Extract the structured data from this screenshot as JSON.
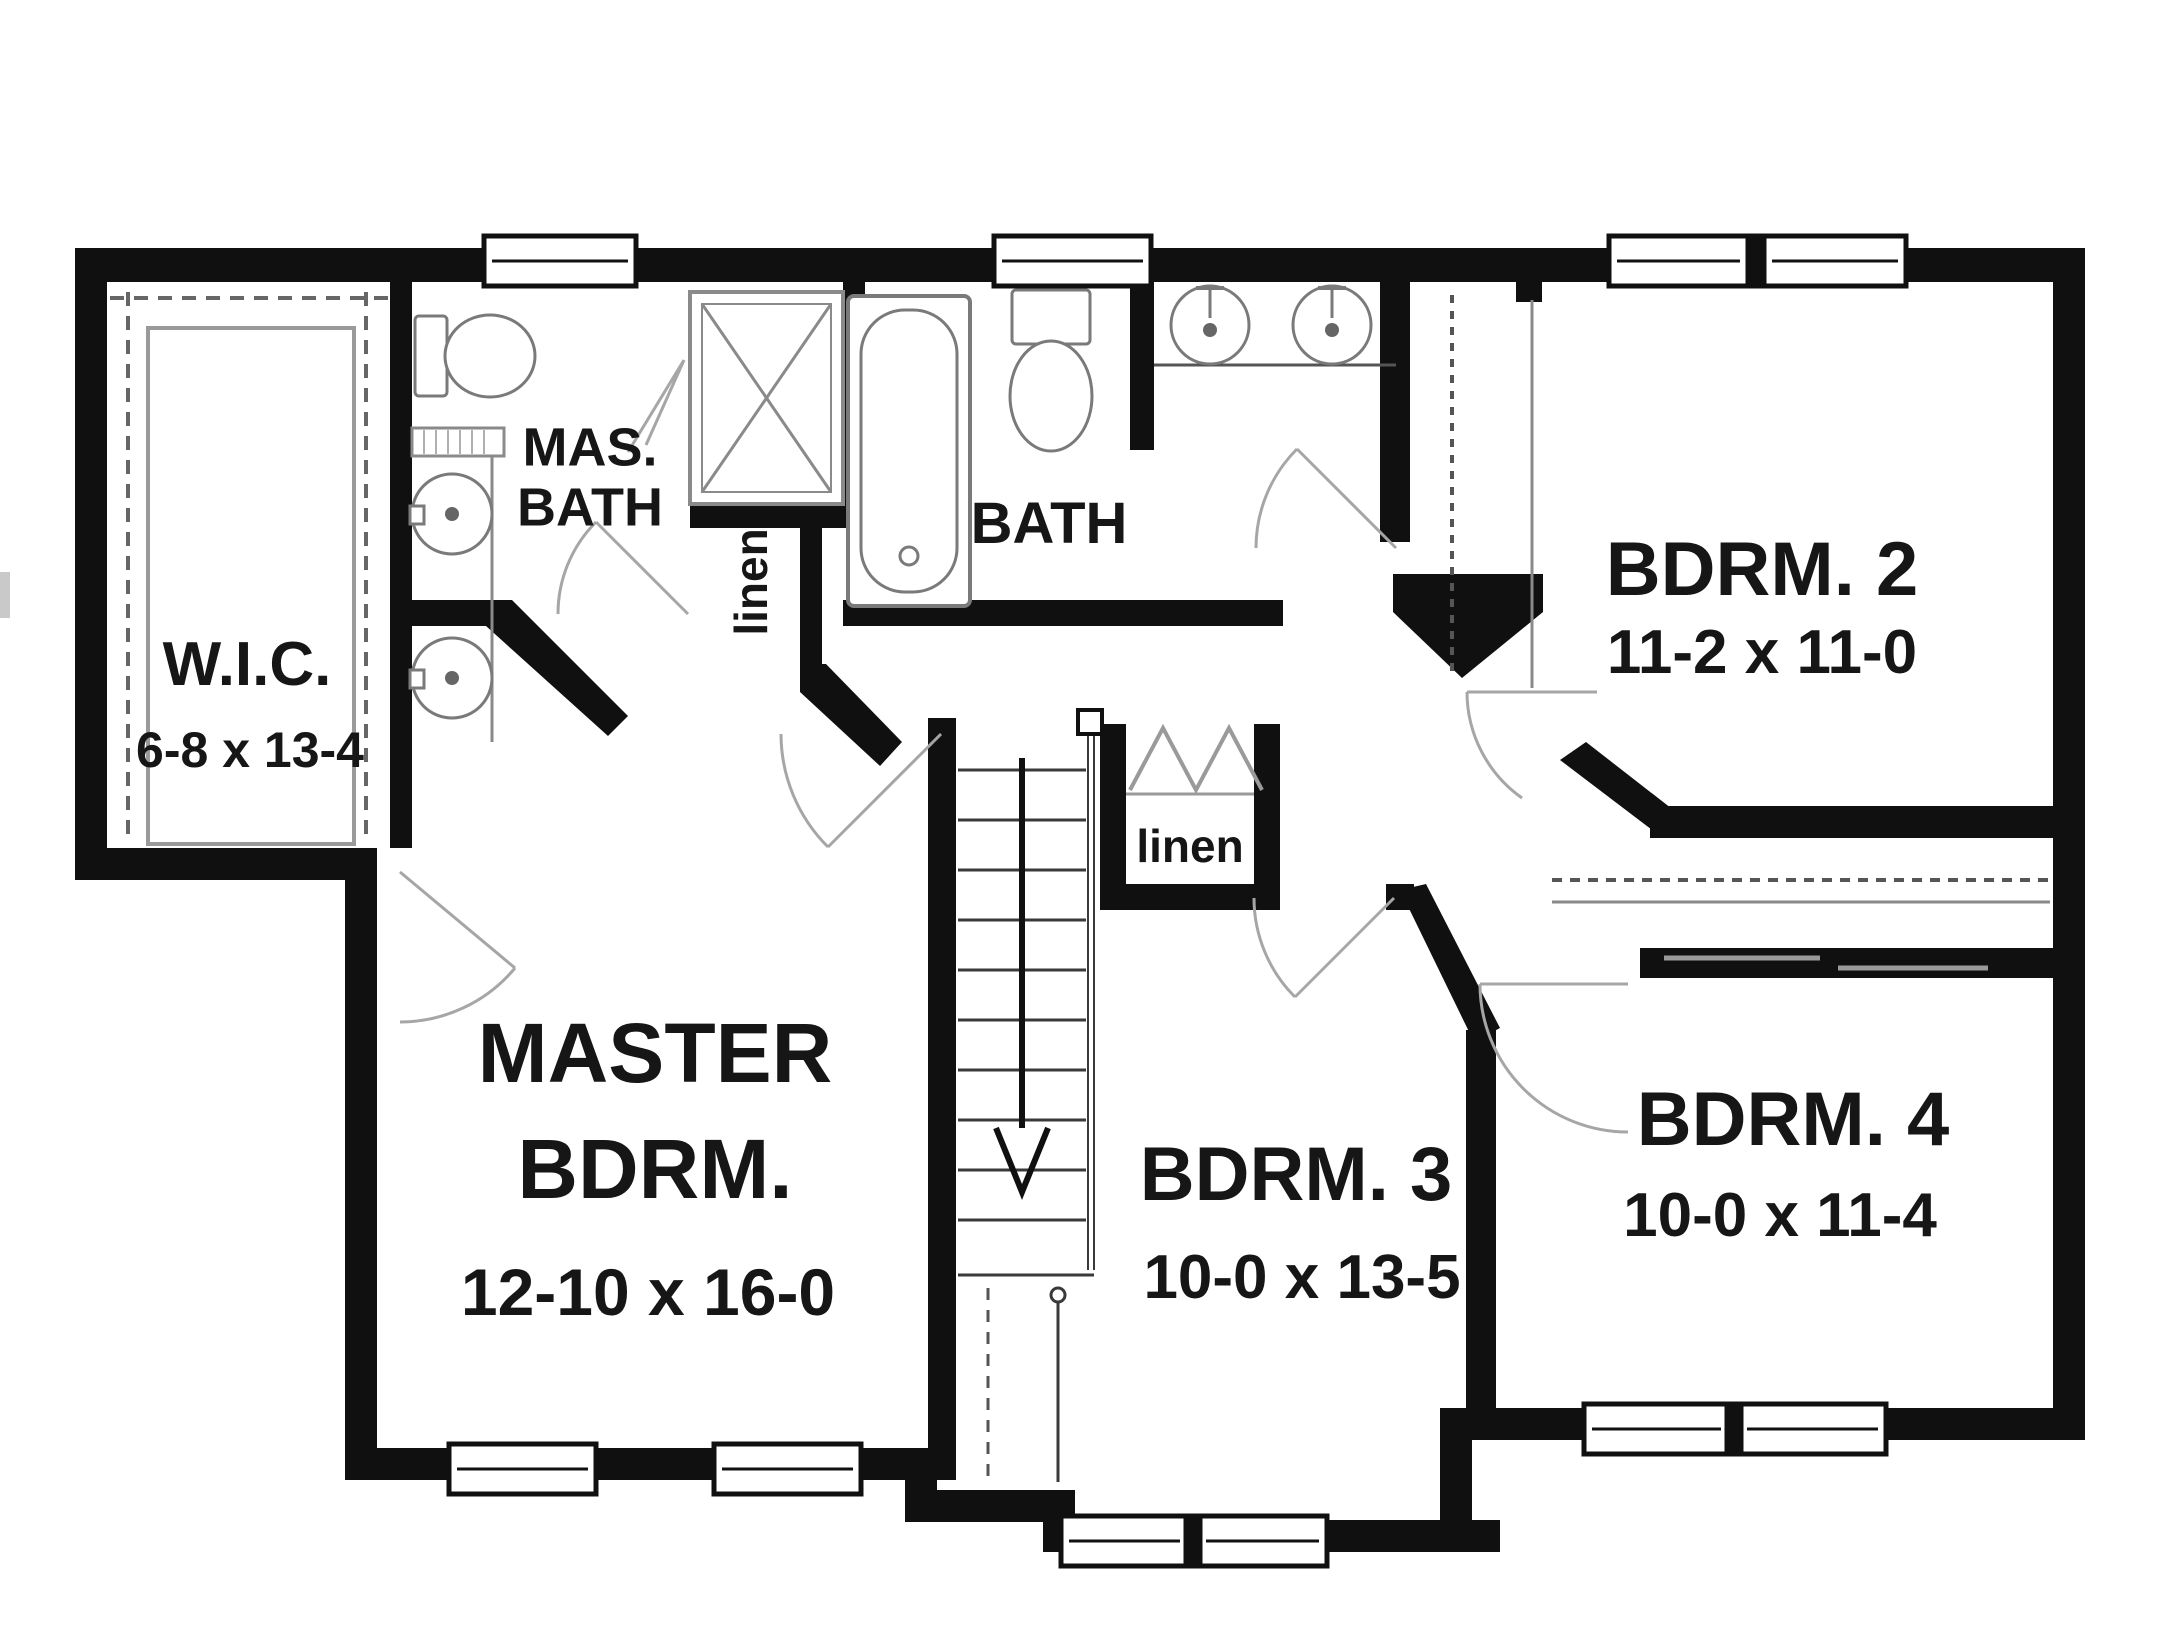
{
  "plan": {
    "rooms": {
      "wic": {
        "name": "W.I.C.",
        "dims": "6-8 x 13-4"
      },
      "mas_bath": {
        "line1": "MAS.",
        "line2": "BATH"
      },
      "bath": {
        "name": "BATH"
      },
      "bdrm2": {
        "name": "BDRM. 2",
        "dims": "11-2 x 11-0"
      },
      "master": {
        "line1": "MASTER",
        "line2": "BDRM.",
        "dims": "12-10 x 16-0"
      },
      "bdrm3": {
        "name": "BDRM. 3",
        "dims": "10-0 x 13-5"
      },
      "bdrm4": {
        "name": "BDRM. 4",
        "dims": "10-0 x 11-4"
      },
      "linen_upper": {
        "name": "linen"
      },
      "linen_center": {
        "name": "linen"
      }
    },
    "colors": {
      "wall": "#101010",
      "background": "#ffffff",
      "fixture": "#7a7a7a",
      "door_arc": "#a6a6a6"
    }
  }
}
